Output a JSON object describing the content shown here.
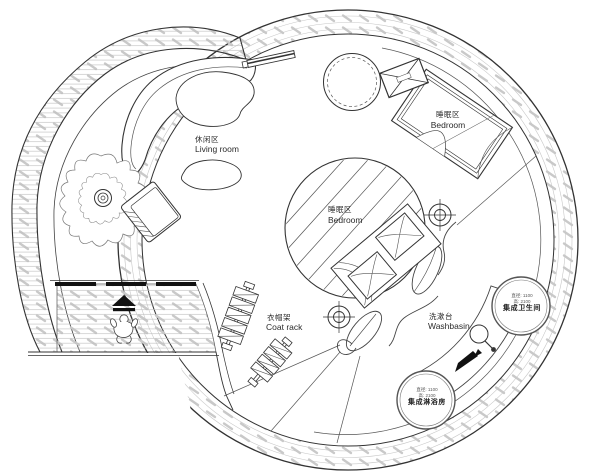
{
  "drawing": {
    "kind": "circular tiny-house floor plan",
    "colors": {
      "ink": "#333333",
      "thin_ink": "#555555",
      "hatch": "#c9c9c9",
      "background": "#ffffff",
      "solid_black": "#111111"
    }
  },
  "areas": {
    "living_room": {
      "zh": "休闲区",
      "en": "Living room"
    },
    "bedroom_upper": {
      "zh": "睡眠区",
      "en": "Bedroom"
    },
    "bedroom_center": {
      "zh": "睡眠区",
      "en": "Bedroom"
    },
    "coat_rack": {
      "zh": "衣帽架",
      "en": "Coat rack"
    },
    "washbasin": {
      "zh": "洗漱台",
      "en": "Washbasin"
    }
  },
  "units": {
    "integrated_bathroom": {
      "name": "集成卫生间",
      "dim_line1": "直径: 1100",
      "dim_line2": "高: 2100"
    },
    "integrated_shower": {
      "name": "集成淋浴房",
      "dim_line1": "直径: 1100",
      "dim_line2": "高: 2100"
    }
  },
  "icons": {
    "survey_point": "crosshair-target",
    "entrance_arrow": "up-arrow",
    "flow_arrow": "down-left-arrow",
    "equipment_box": "crossed-box",
    "faucet": "tap-circle"
  }
}
